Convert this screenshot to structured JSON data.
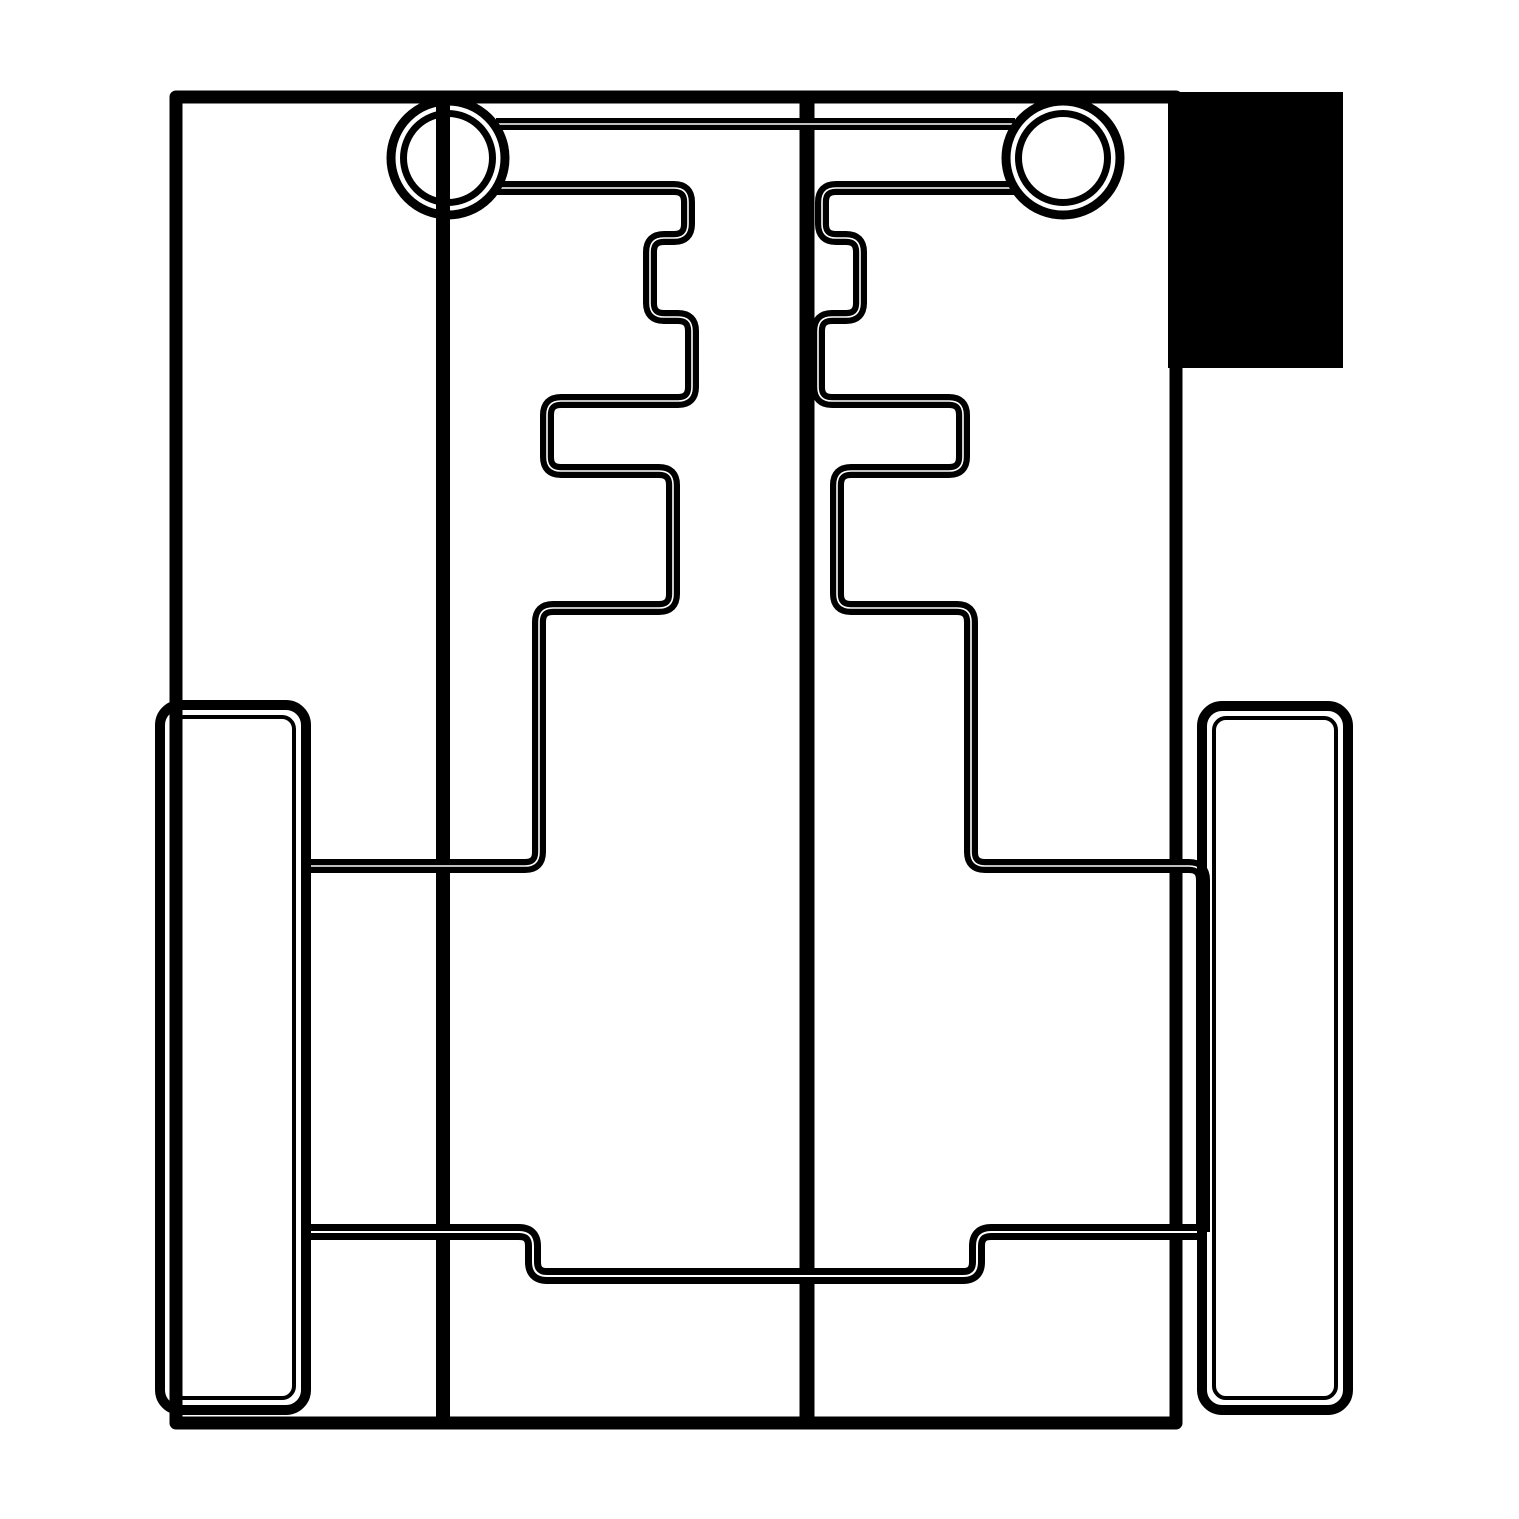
{
  "drawing": {
    "title": "chassis-cut-outline-drawing",
    "canvas": {
      "width": 1519,
      "height": 1519,
      "background": "#ffffff"
    },
    "colors": {
      "stroke": "#000000",
      "fill_block": "#000000",
      "hairline": "#ffffff"
    },
    "shapes": [
      {
        "name": "corner-fill-block",
        "kind": "rect",
        "x": 1168,
        "y": 92,
        "w": 175,
        "h": 276,
        "fill": "#000000"
      },
      {
        "name": "board-outline",
        "kind": "rect",
        "x": 176,
        "y": 97,
        "w": 1000,
        "h": 1326,
        "sw": 13
      },
      {
        "name": "panel-divider-left",
        "kind": "line",
        "x1": 443,
        "y1": 97,
        "x2": 443,
        "y2": 1423,
        "sw": 14
      },
      {
        "name": "panel-divider-center",
        "kind": "line",
        "x1": 807,
        "y1": 97,
        "x2": 807,
        "y2": 1423,
        "sw": 15
      },
      {
        "name": "axle-slot-top-edge",
        "kind": "line",
        "x1": 496,
        "y1": 124,
        "x2": 1015,
        "y2": 124,
        "sw": 12,
        "hair": 1.5
      },
      {
        "name": "left-bracket-outline",
        "kind": "path",
        "sw": 14,
        "hair": 1.6,
        "d": "M496,188 L674,188 Q688,188 688,202 L688,224 Q688,238 674,238 L664,238 Q650,238 650,252 L650,303 Q650,317 664,317 L678,317 Q692,317 692,331 L692,387 Q692,401 678,401 L561,401 Q547,401 547,415 L547,457 Q547,471 561,471 L659,471 Q673,471 673,485 L673,594 Q673,608 659,608 L553,608 Q539,608 539,622 L539,852 Q539,866 525,866 L302,866"
      },
      {
        "name": "right-bracket-outline",
        "kind": "path",
        "sw": 14,
        "hair": 1.6,
        "d": "M1015,188 L836,188 Q822,188 822,202 L822,224 Q822,238 836,238 L846,238 Q860,238 860,252 L860,303 Q860,317 846,317 L832,317 Q818,317 818,331 L818,387 Q818,401 832,401 L949,401 Q963,401 963,415 L963,457 Q963,471 949,471 L851,471 Q837,471 837,485 L837,594 Q837,608 851,608 L957,608 Q971,608 971,622 L971,852 Q971,866 985,866 L1189,866 Q1203,866 1203,880 L1203,1232"
      },
      {
        "name": "lower-crossbar-channel",
        "kind": "path",
        "sw": 16,
        "hair": 2,
        "d": "M302,1232 L519,1232 Q533,1232 533,1246 L533,1262 Q533,1276 547,1276 L963,1276 Q977,1276 977,1262 L977,1246 Q977,1232 991,1232 L1203,1232"
      },
      {
        "name": "left-hub-outer-circle",
        "kind": "circle",
        "cx": 448,
        "cy": 158,
        "r": 57,
        "sw": 9
      },
      {
        "name": "left-hub-inner-circle",
        "kind": "circle",
        "cx": 448,
        "cy": 158,
        "r": 44.5,
        "sw": 7
      },
      {
        "name": "right-hub-outer-circle",
        "kind": "circle",
        "cx": 1063,
        "cy": 158,
        "r": 57,
        "sw": 9
      },
      {
        "name": "right-hub-inner-circle",
        "kind": "circle",
        "cx": 1063,
        "cy": 158,
        "r": 44.5,
        "sw": 7
      },
      {
        "name": "left-wheel-outline",
        "kind": "rect",
        "x": 160,
        "y": 705,
        "w": 146,
        "h": 705,
        "rx": 20,
        "sw": 10
      },
      {
        "name": "left-wheel-inner-line",
        "kind": "rect",
        "x": 172,
        "y": 717,
        "w": 122,
        "h": 681,
        "rx": 12,
        "sw": 4
      },
      {
        "name": "right-wheel-outline",
        "kind": "rect",
        "x": 1202,
        "y": 706,
        "w": 146,
        "h": 704,
        "rx": 20,
        "sw": 10
      },
      {
        "name": "right-wheel-inner-line",
        "kind": "rect",
        "x": 1214,
        "y": 718,
        "w": 122,
        "h": 680,
        "rx": 12,
        "sw": 4
      }
    ]
  }
}
